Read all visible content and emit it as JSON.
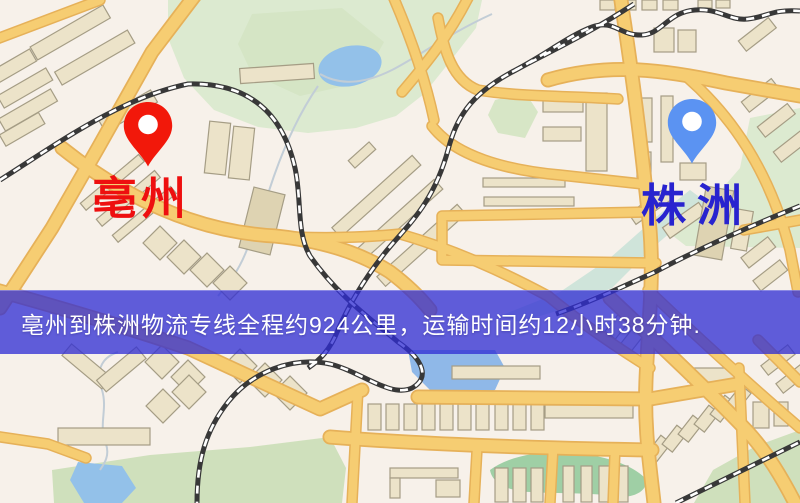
{
  "map": {
    "kind": "logistics-route-map",
    "banner": {
      "text": "亳州到株洲物流专线全程约924公里，运输时间约12小时38分钟.",
      "background": "rgba(47,45,212,0.76)",
      "text_color": "#ffffff"
    },
    "route": {
      "origin": "亳州",
      "destination": "株洲",
      "line_name": "亳州到株洲物流专线",
      "distance_text": "全程约924公里",
      "duration_text": "运输时间约12小时38分钟"
    },
    "markers": [
      {
        "id": "origin",
        "label": "亳州",
        "icon": "map-pin",
        "pin_color": "#f2180a",
        "label_color": "#ee0f0f"
      },
      {
        "id": "destination",
        "label": "株洲",
        "icon": "map-pin",
        "pin_color": "#5b93f2",
        "label_color": "#2823cf"
      }
    ],
    "colors": {
      "background": "#f7f1ea",
      "road": "#f6cd72",
      "road_casing": "#e6b159",
      "building": "#ece3c9",
      "building_outline": "#a59d85",
      "park": "#dcead0",
      "park_dark": "#cfe0bc",
      "water": "#93c1e9",
      "river": "#cfe4da",
      "railway": "#383838"
    }
  }
}
